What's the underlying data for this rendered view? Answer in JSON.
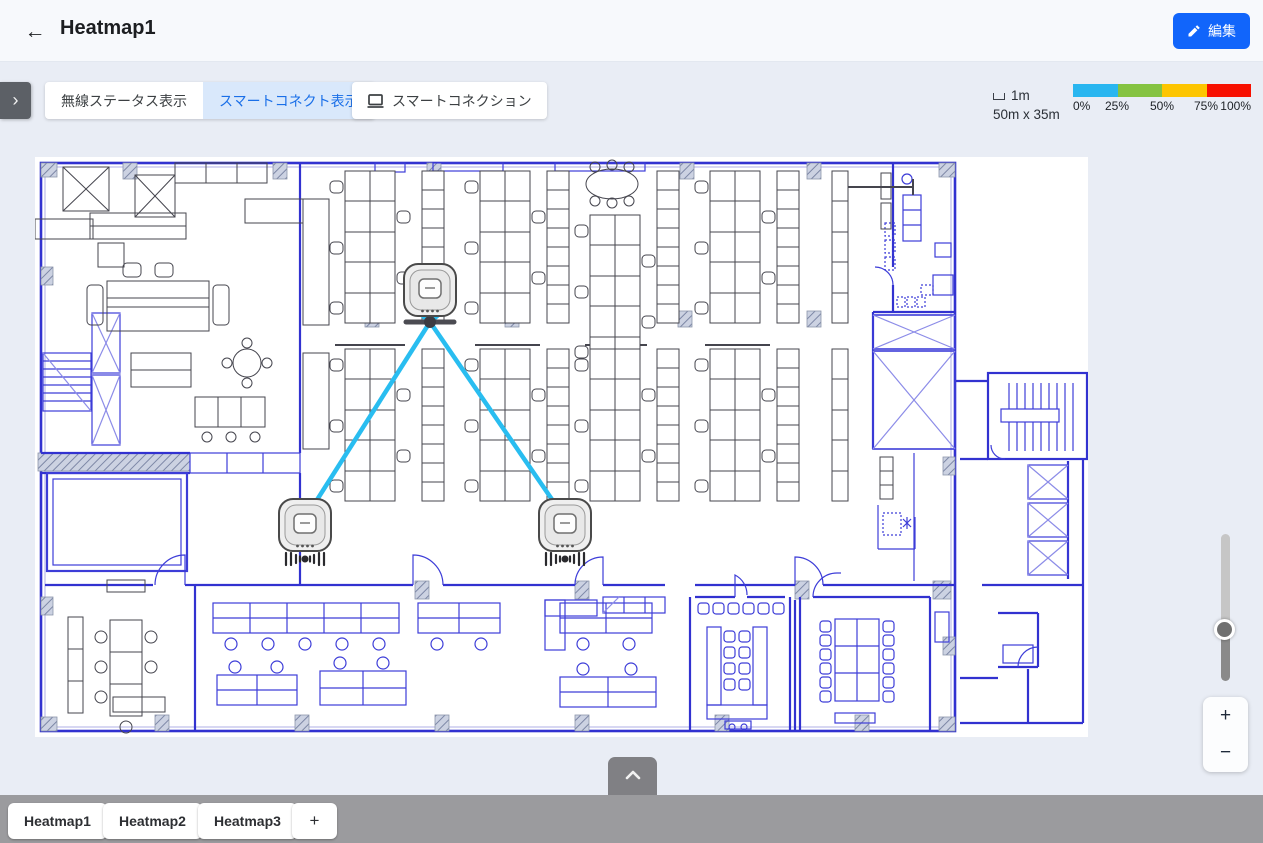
{
  "header": {
    "back_icon": "←",
    "title": "Heatmap1",
    "edit_button": {
      "label": "編集"
    }
  },
  "toolbar": {
    "drawer_toggle_icon": "›",
    "buttons": [
      {
        "id": "wireless-status",
        "label": "無線ステータス表示",
        "active": false
      },
      {
        "id": "smart-connect-display",
        "label": "スマートコネクト表示",
        "active": true
      },
      {
        "id": "smart-connection",
        "label": "スマートコネクション",
        "active": false,
        "icon": "monitor-icon"
      }
    ]
  },
  "map_info": {
    "scale_value": "1m",
    "dimensions": "50m x 35m"
  },
  "heat_legend": {
    "segments": [
      {
        "color": "#29b6f0",
        "range_start": "0%"
      },
      {
        "color": "#85c341",
        "range_start": "25%"
      },
      {
        "color": "#fdc500",
        "range_start": "50%"
      },
      {
        "color": "#f71000",
        "range_start": "75%"
      }
    ],
    "labels": [
      "0%",
      "25%",
      "50%",
      "75%",
      "100%"
    ]
  },
  "access_points": [
    {
      "id": "ap-top",
      "x": 430,
      "y": 290,
      "signal_icon": false
    },
    {
      "id": "ap-bottom-left",
      "x": 305,
      "y": 525,
      "signal_icon": true
    },
    {
      "id": "ap-bottom-right",
      "x": 565,
      "y": 525,
      "signal_icon": true
    }
  ],
  "connections": {
    "junction": {
      "x": 430,
      "y": 322
    },
    "links": [
      [
        430,
        322,
        416,
        310
      ],
      [
        430,
        322,
        444,
        310
      ],
      [
        430,
        322,
        308,
        514
      ],
      [
        430,
        322,
        562,
        514
      ]
    ]
  },
  "zoom_controls": {
    "zoom_in": "+",
    "zoom_out": "−"
  },
  "bottom_tabs": {
    "tabs": [
      {
        "label": "Heatmap1",
        "active": true
      },
      {
        "label": "Heatmap2",
        "active": false
      },
      {
        "label": "Heatmap3",
        "active": false
      }
    ],
    "add_label": "+"
  },
  "colors": {
    "edit_button": "#1165fb",
    "active_tab_bg": "#d9e8fb",
    "active_tab_text": "#1a6fe8",
    "connection_line": "#29bdf0"
  }
}
